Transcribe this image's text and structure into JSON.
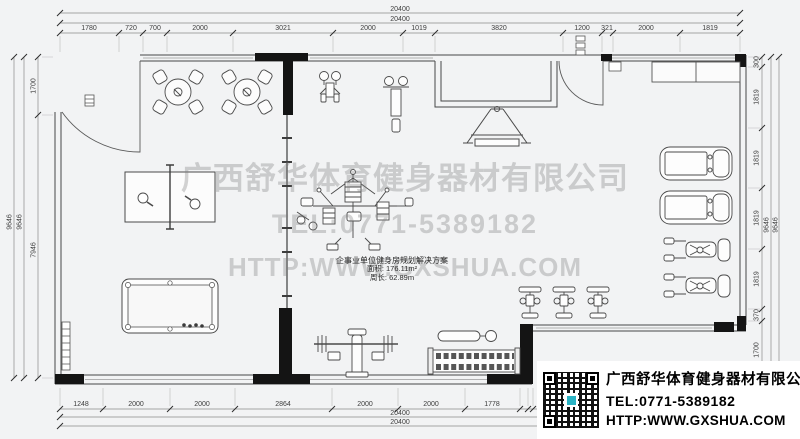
{
  "watermark": {
    "line1": "广西舒华体育健身器材有限公司",
    "line2": "TEL:0771-5389182",
    "line3": "HTTP:WWW.GXSHUA.COM"
  },
  "plan_label": {
    "title": "企事业单位健身房规划解决方案",
    "area": "面积: 176.11m²",
    "perimeter": "周长: 62.89m"
  },
  "info_block": {
    "company": "广西舒华体育健身器材有限公司",
    "tel": "TEL:0771-5389182",
    "website": "HTTP:WWW.GXSHUA.COM"
  },
  "dims": {
    "top_total": "20400",
    "bottom_total": "20400",
    "left_total": "9646",
    "right_total": "9646",
    "top": [
      "1780",
      "720",
      "700",
      "2000",
      "3021",
      "2000",
      "1019",
      "3820",
      "1200",
      "321",
      "2000",
      "1819"
    ],
    "bottom": [
      "1248",
      "2000",
      "2000",
      "2864",
      "2000",
      "2000",
      "1778"
    ],
    "left": [
      "1700",
      "7946"
    ],
    "right": [
      "300",
      "1819",
      "1819",
      "1819",
      "1819",
      "370",
      "1700"
    ]
  },
  "colors": {
    "background": "#f2f3f4",
    "line": "#4a4a4a",
    "column": "#141414",
    "qr_logo_teal": "#2ab3c4"
  }
}
